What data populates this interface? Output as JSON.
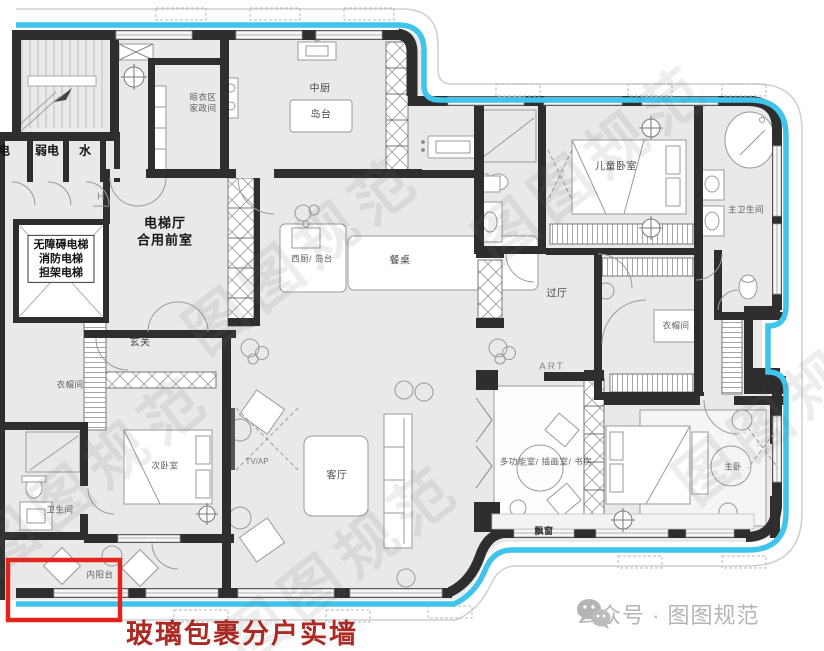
{
  "watermark": {
    "text": "图图规范"
  },
  "footer": {
    "account_text": "公众号 · 图图规范",
    "icon": "wechat-icon"
  },
  "annotation": {
    "caption": "玻璃包裹分户实墙"
  },
  "rooms": {
    "power": "电",
    "low_voltage": "弱电",
    "water": "水",
    "h_mark": "H",
    "elevators": "无障碍电梯\n消防电梯\n担架电梯",
    "lift_lobby": "电梯厅\n合用前室",
    "laundry": "晾衣区\n家政间",
    "kitchen": "中厨",
    "island": "岛台",
    "west_kitchen": "西厨/ 岛台",
    "dining_table": "餐桌",
    "foyer": "玄关",
    "cloakroom_left": "衣帽间",
    "bathroom_left": "卫生间",
    "second_bedroom": "次卧室",
    "inner_balcony": "内阳台",
    "tv_wall": "TV/AP",
    "living_room": "客厅",
    "kids_bedroom": "儿童卧室",
    "hallway": "过厅",
    "master_bathroom": "主卫生间",
    "cloakroom_middle": "衣帽间",
    "art_label": "ART",
    "multi_room": "多功能室/ 插画室/ 书房",
    "master_bedroom": "主卧",
    "bay_window": "飘窗"
  },
  "colors": {
    "boundary_blue": "#3fc4ec",
    "wall_dark": "#2e2e2e",
    "plan_fill": "#e9e9e9",
    "highlight_red": "#e3241b",
    "caption_red": "#ab2a23",
    "footer_gray": "#b5b5b5"
  }
}
